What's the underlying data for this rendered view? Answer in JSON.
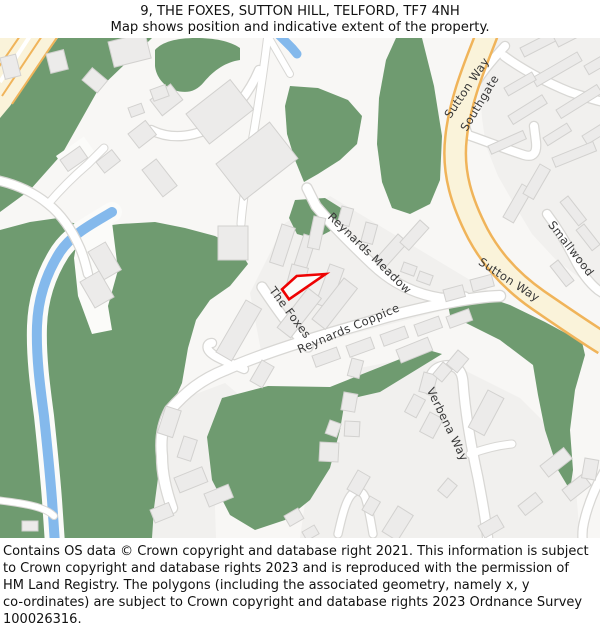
{
  "header": {
    "title": "9, THE FOXES, SUTTON HILL, TELFORD, TF7 4NH",
    "subtitle": "Map shows position and indicative extent of the property."
  },
  "map": {
    "street_labels": {
      "reynards_meadow": "Reynards Meadow",
      "the_foxes": "The Foxes",
      "reynards_coppice": "Reynards Coppice",
      "sutton_way_top": "Sutton Way",
      "southgate": "Southgate",
      "sutton_way_mid": "Sutton Way",
      "smallwood": "Smallwood",
      "verbena_way": "Verbena Way"
    },
    "colors": {
      "greenspace": "#6f9b70",
      "water": "#84b9ec",
      "primary_road_fill": "#faf3da",
      "primary_road_casing": "#f0b45a",
      "road_fill": "#ffffff",
      "road_casing": "#d8d7d4",
      "building_fill": "#ecebea",
      "building_stroke": "#d2d1cf",
      "block": "#f1f0ee",
      "open_land": "#fbfbf9",
      "map_bg": "#f8f7f5",
      "property_outline": "#ee0202",
      "label_color": "#383838"
    }
  },
  "footer": {
    "lines": [
      "Contains OS data © Crown copyright and database right 2021. This information is subject",
      "to Crown copyright and database rights 2023 and is reproduced with the permission of",
      "HM Land Registry. The polygons (including the associated geometry, namely x, y",
      "co-ordinates) are subject to Crown copyright and database rights 2023 Ordnance Survey",
      "100026316."
    ]
  }
}
